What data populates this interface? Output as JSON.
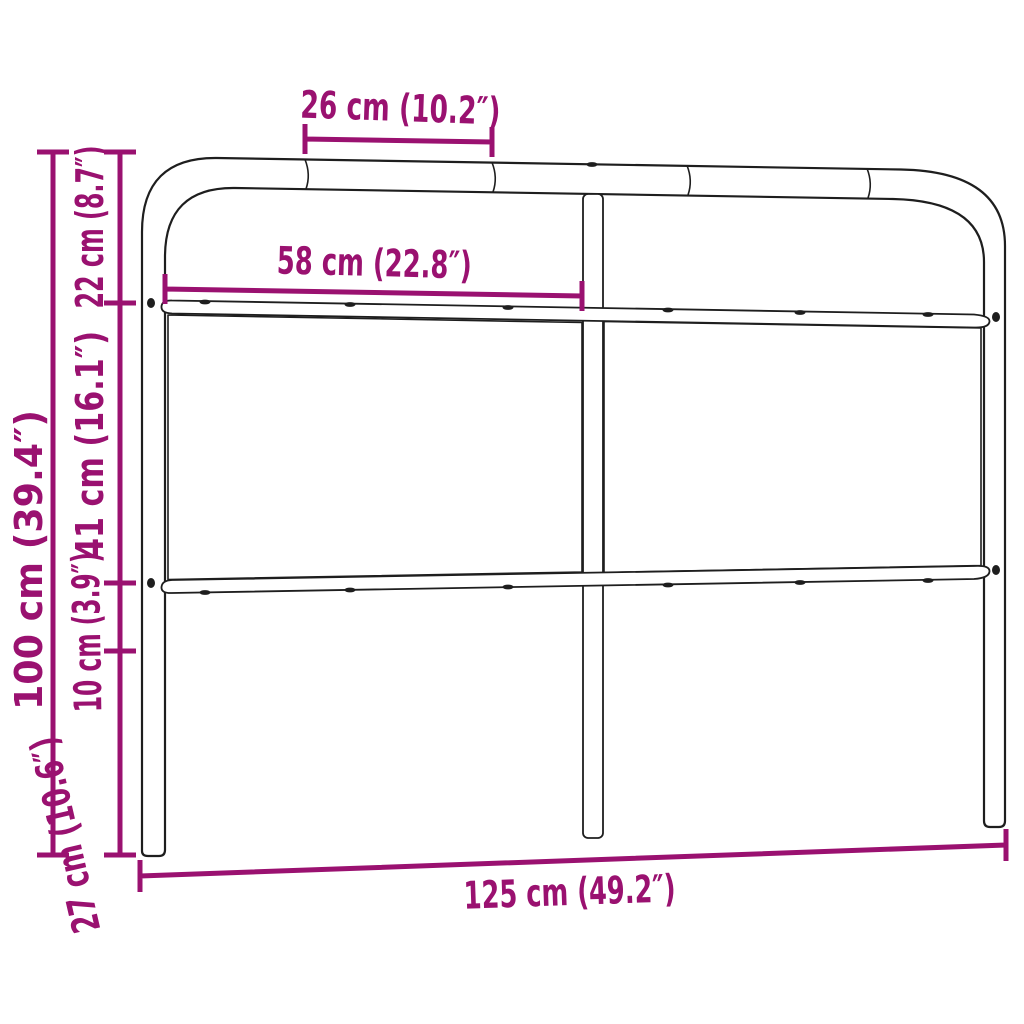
{
  "colors": {
    "dimension_accent": "#9a1170",
    "outline": "#1e1e1e",
    "background": "#ffffff"
  },
  "diagram": {
    "kind": "product-dimension-line-drawing",
    "dimensions": {
      "top_segment": {
        "label": "26 cm (10.2″)",
        "cm": 26,
        "inches": 10.2
      },
      "top_height": {
        "label": "22 cm (8.7″)",
        "cm": 22,
        "inches": 8.7
      },
      "inner_width": {
        "label": "58 cm (22.8″)",
        "cm": 58,
        "inches": 22.8
      },
      "panel_height": {
        "label": "41 cm (16.1″)",
        "cm": 41,
        "inches": 16.1
      },
      "rail_offset": {
        "label": "10 cm (3.9″)",
        "cm": 10,
        "inches": 3.9
      },
      "leg_height": {
        "label": "27 cm (10.6″)",
        "cm": 27,
        "inches": 10.6
      },
      "total_height": {
        "label": "100 cm (39.4″)",
        "cm": 100,
        "inches": 39.4
      },
      "total_width": {
        "label": "125 cm (49.2″)",
        "cm": 125,
        "inches": 49.2
      }
    }
  }
}
